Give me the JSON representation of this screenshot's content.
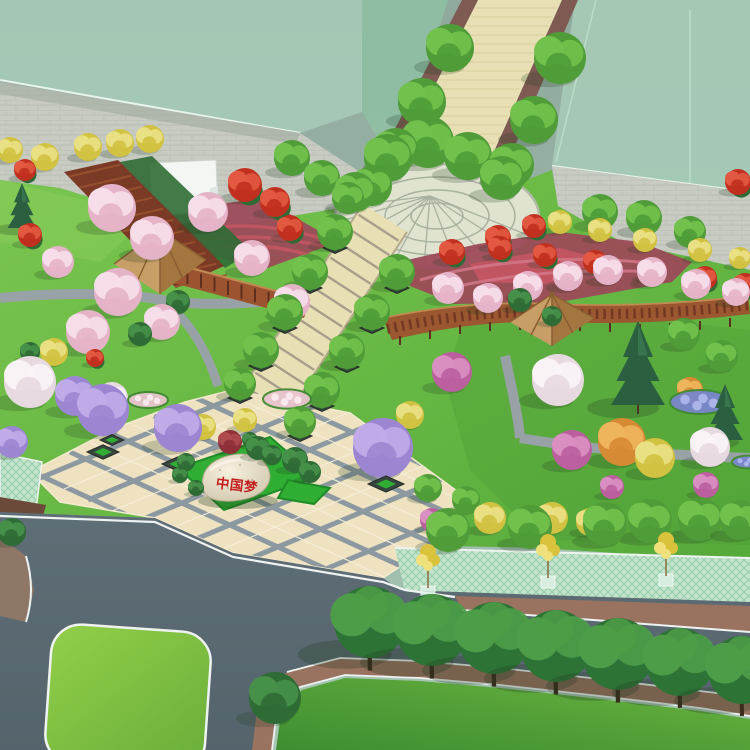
{
  "scene": {
    "kind": "aerial-park-landscape-render",
    "inscription": {
      "text": "中国梦",
      "color": "#c41e1e"
    },
    "palette": {
      "ground": {
        "lawn": "#6cbb45",
        "road": "#5b6a72",
        "road_line": "#eef3f2",
        "plaza_tile": "#eee2c0",
        "plaza_joint": "#8d99a1",
        "walkway": "#e8dfb4",
        "walkway_edge": "#7e5a52",
        "paving": "#c7cbc2",
        "sidewalk_brick": "#9a7260",
        "median": "#8f7767",
        "mint": "#c2e4cc",
        "mint_line": "#93c9a5",
        "bed_maroon": "#9c4a58",
        "bed_crimson": "#c25562",
        "wood_dark": "#7a3a26",
        "wood_mid": "#9c5430",
        "wood_light": "#c08a52",
        "roof": "#c79e66",
        "roof_shade": "#a3753f",
        "hedge": "#2f6b35",
        "island_green": "#2fae33",
        "ghost": "#a5cab6",
        "ghost_deep": "#8fbfa4",
        "tent": "#f3f7f3",
        "path": "#98a2a6",
        "inscription_red": "#c41e1e"
      },
      "veg": {
        "g": [
          "#4f9c38",
          "#72c14c"
        ],
        "st": [
          "#2e7336",
          "#4d9d48"
        ],
        "b": [
          "#2f6b35",
          "#47904a"
        ],
        "c": [
          "#2a5f40",
          "#3f7f55"
        ],
        "p": [
          "#e5b3c8",
          "#f6dde9"
        ],
        "w": [
          "#e7d9e0",
          "#faf3f6"
        ],
        "v": [
          "#9c86d2",
          "#c0abe8"
        ],
        "y": [
          "#d2c242",
          "#e9e084"
        ],
        "o": [
          "#d68a33",
          "#efb55c"
        ],
        "r": [
          "#c1301f",
          "#e25840"
        ],
        "m": [
          "#bb5f9e",
          "#da8fc2"
        ],
        "mp": [
          "#8e3038",
          "#ad4a4e"
        ],
        "s": [
          "#d9c23c",
          "#efe07c"
        ],
        "fbb": [
          "#7a86cc",
          "#aab4e8"
        ],
        "fbp": [
          "#e8c3ce",
          "#f8e7ec"
        ],
        "pl": [
          "#39453f",
          "#2fae33"
        ]
      }
    },
    "objects": [
      [
        "y",
        10,
        150,
        13
      ],
      [
        "y",
        45,
        157,
        14
      ],
      [
        "y",
        88,
        147,
        14
      ],
      [
        "y",
        120,
        143,
        14
      ],
      [
        "y",
        150,
        139,
        14
      ],
      [
        "r",
        25,
        170,
        11
      ],
      [
        "c",
        22,
        220,
        16
      ],
      [
        "r",
        30,
        235,
        12
      ],
      [
        "g",
        450,
        48,
        24
      ],
      [
        "g",
        422,
        102,
        24
      ],
      [
        "g",
        396,
        150,
        22
      ],
      [
        "g",
        372,
        186,
        20
      ],
      [
        "g",
        560,
        58,
        26
      ],
      [
        "g",
        534,
        120,
        24
      ],
      [
        "g",
        512,
        165,
        22
      ],
      [
        "g",
        388,
        158,
        24
      ],
      [
        "g",
        428,
        142,
        26
      ],
      [
        "g",
        468,
        156,
        24
      ],
      [
        "g",
        502,
        178,
        22
      ],
      [
        "g",
        355,
        192,
        20
      ],
      [
        "g",
        292,
        158,
        18
      ],
      [
        "g",
        322,
        178,
        18
      ],
      [
        "g",
        348,
        198,
        16
      ],
      [
        "r",
        245,
        185,
        17
      ],
      [
        "r",
        275,
        202,
        15
      ],
      [
        "r",
        290,
        228,
        13
      ],
      [
        "r",
        738,
        182,
        13
      ],
      [
        "p",
        112,
        208,
        24
      ],
      [
        "p",
        152,
        238,
        22
      ],
      [
        "p",
        208,
        212,
        20
      ],
      [
        "p",
        252,
        258,
        18
      ],
      [
        "p",
        292,
        302,
        18
      ],
      [
        "p",
        118,
        292,
        24
      ],
      [
        "p",
        88,
        332,
        22
      ],
      [
        "p",
        162,
        322,
        18
      ],
      [
        "p",
        58,
        262,
        16
      ],
      [
        "y",
        560,
        222,
        12
      ],
      [
        "y",
        600,
        230,
        12
      ],
      [
        "y",
        645,
        240,
        12
      ],
      [
        "y",
        700,
        250,
        12
      ],
      [
        "y",
        740,
        258,
        11
      ],
      [
        "r",
        500,
        248,
        12
      ],
      [
        "r",
        545,
        255,
        12
      ],
      [
        "r",
        595,
        262,
        12
      ],
      [
        "r",
        650,
        270,
        12
      ],
      [
        "r",
        705,
        278,
        12
      ],
      [
        "r",
        745,
        285,
        12
      ],
      [
        "r",
        452,
        252,
        13
      ],
      [
        "r",
        498,
        238,
        13
      ],
      [
        "r",
        534,
        226,
        12
      ],
      [
        "g",
        600,
        212,
        18
      ],
      [
        "g",
        644,
        218,
        18
      ],
      [
        "g",
        690,
        232,
        16
      ],
      [
        "p",
        448,
        288,
        16
      ],
      [
        "p",
        488,
        298,
        15
      ],
      [
        "p",
        528,
        286,
        15
      ],
      [
        "p",
        568,
        276,
        15
      ],
      [
        "p",
        608,
        270,
        15
      ],
      [
        "p",
        652,
        272,
        15
      ],
      [
        "p",
        696,
        284,
        15
      ],
      [
        "p",
        736,
        292,
        14
      ],
      [
        "b",
        520,
        300,
        12
      ],
      [
        "b",
        552,
        316,
        10
      ],
      [
        "g",
        684,
        334,
        16
      ],
      [
        "g",
        722,
        356,
        16
      ],
      [
        "m",
        452,
        372,
        20
      ],
      [
        "w",
        558,
        380,
        26
      ],
      [
        "c",
        638,
        390,
        30
      ],
      [
        "o",
        690,
        390,
        13
      ],
      [
        "fbb",
        700,
        402,
        30
      ],
      [
        "b",
        140,
        334,
        12
      ],
      [
        "b",
        178,
        302,
        12
      ],
      [
        "b",
        30,
        352,
        10
      ],
      [
        "y",
        54,
        352,
        14
      ],
      [
        "r",
        95,
        358,
        9
      ],
      [
        "w",
        30,
        382,
        26
      ],
      [
        "v",
        75,
        396,
        20
      ],
      [
        "v",
        103,
        410,
        26
      ],
      [
        "w",
        112,
        398,
        16
      ],
      [
        "v",
        12,
        442,
        16
      ],
      [
        "fbp",
        148,
        400,
        20
      ],
      [
        "fbp",
        287,
        399,
        24
      ],
      [
        "g",
        335,
        232,
        18
      ],
      [
        "g",
        310,
        272,
        18
      ],
      [
        "g",
        285,
        312,
        18
      ],
      [
        "g",
        261,
        350,
        18
      ],
      [
        "g",
        240,
        384,
        16
      ],
      [
        "g",
        397,
        272,
        18
      ],
      [
        "g",
        372,
        312,
        18
      ],
      [
        "g",
        347,
        351,
        18
      ],
      [
        "g",
        322,
        390,
        18
      ],
      [
        "g",
        300,
        422,
        16
      ],
      [
        "pl",
        335,
        248,
        12
      ],
      [
        "pl",
        310,
        288,
        12
      ],
      [
        "pl",
        285,
        328,
        12
      ],
      [
        "pl",
        261,
        366,
        12
      ],
      [
        "pl",
        240,
        398,
        12
      ],
      [
        "pl",
        397,
        288,
        12
      ],
      [
        "pl",
        372,
        328,
        12
      ],
      [
        "pl",
        347,
        367,
        12
      ],
      [
        "pl",
        322,
        406,
        12
      ],
      [
        "pl",
        300,
        436,
        12
      ],
      [
        "v",
        178,
        428,
        24
      ],
      [
        "pl",
        178,
        464,
        16
      ],
      [
        "v",
        383,
        448,
        30
      ],
      [
        "pl",
        386,
        484,
        18
      ],
      [
        "pl",
        103,
        452,
        16
      ],
      [
        "pl",
        112,
        440,
        12
      ],
      [
        "y",
        203,
        427,
        13
      ],
      [
        "y",
        245,
        420,
        12
      ],
      [
        "mp",
        230,
        442,
        12
      ],
      [
        "b",
        258,
        448,
        12
      ],
      [
        "b",
        272,
        455,
        10
      ],
      [
        "b",
        250,
        440,
        8
      ],
      [
        "b",
        295,
        460,
        13
      ],
      [
        "b",
        310,
        472,
        11
      ],
      [
        "b",
        186,
        462,
        9
      ],
      [
        "b",
        180,
        475,
        8
      ],
      [
        "b",
        196,
        488,
        8
      ],
      [
        "y",
        410,
        415,
        14
      ],
      [
        "m",
        572,
        450,
        20
      ],
      [
        "y",
        655,
        458,
        20
      ],
      [
        "o",
        622,
        442,
        24
      ],
      [
        "c",
        725,
        430,
        20
      ],
      [
        "w",
        710,
        447,
        20
      ],
      [
        "fbb",
        748,
        462,
        16
      ],
      [
        "m",
        612,
        487,
        12
      ],
      [
        "m",
        706,
        485,
        13
      ],
      [
        "m",
        432,
        520,
        12
      ],
      [
        "g",
        428,
        488,
        14
      ],
      [
        "g",
        466,
        500,
        14
      ],
      [
        "y",
        490,
        518,
        16
      ],
      [
        "y",
        552,
        518,
        16
      ],
      [
        "y",
        590,
        522,
        14
      ],
      [
        "g",
        448,
        530,
        22
      ],
      [
        "g",
        530,
        527,
        22
      ],
      [
        "g",
        605,
        524,
        22
      ],
      [
        "g",
        650,
        521,
        22
      ],
      [
        "g",
        700,
        519,
        22
      ],
      [
        "g",
        740,
        520,
        20
      ],
      [
        "s",
        428,
        560,
        16
      ],
      [
        "s",
        548,
        550,
        16
      ],
      [
        "s",
        666,
        548,
        16
      ],
      [
        "b",
        12,
        532,
        14
      ],
      [
        "st",
        370,
        622,
        36
      ],
      [
        "st",
        432,
        630,
        36
      ],
      [
        "st",
        494,
        638,
        36
      ],
      [
        "st",
        556,
        646,
        36
      ],
      [
        "st",
        618,
        654,
        36
      ],
      [
        "st",
        680,
        662,
        34
      ],
      [
        "st",
        742,
        670,
        34
      ],
      [
        "b",
        275,
        698,
        26
      ]
    ]
  }
}
